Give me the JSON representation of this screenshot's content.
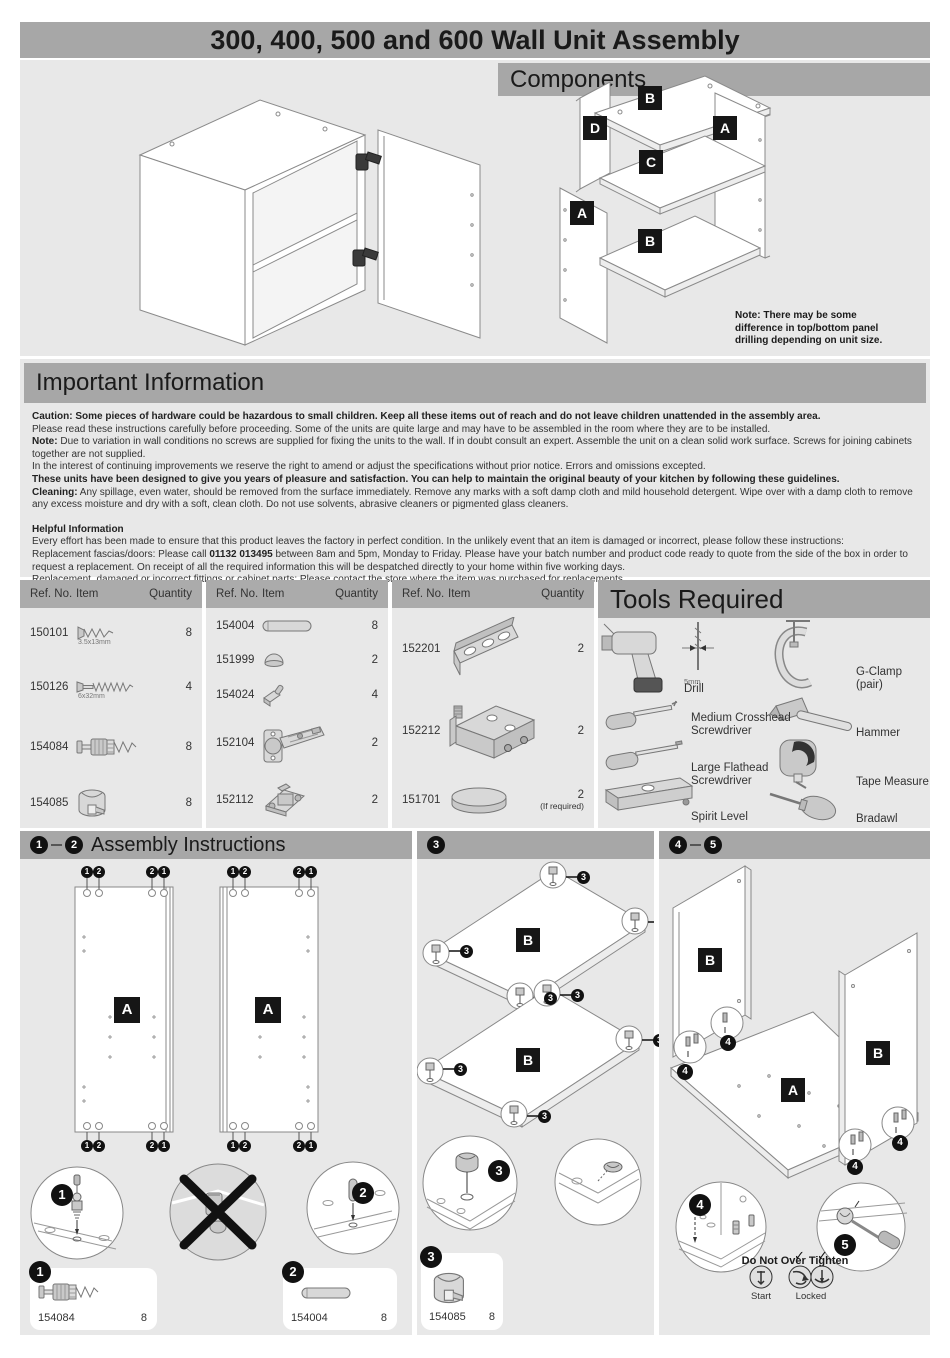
{
  "title": "300, 400, 500 and 600 Wall Unit Assembly",
  "components": {
    "header": "Components",
    "note": "Note: There may be some difference in top/bottom panel drilling depending on unit size.",
    "label_a": "A",
    "label_b": "B",
    "label_c": "C",
    "label_d": "D"
  },
  "important": {
    "header": "Important Information",
    "p1": "Caution: Some pieces of hardware could be hazardous to small children. Keep all these items out of reach and do not leave children unattended in the assembly area.",
    "p2": "Please read these instructions carefully before proceeding. Some of the units are quite large and may have to be assembled in the room where they are to be installed.",
    "p3_bold": "Note:",
    "p3_rest": " Due to variation in wall conditions no screws are supplied for fixing the units to the wall. If in doubt consult an expert. Assemble the unit on a clean solid work surface. Screws for joining cabinets together are not supplied.",
    "p4": "In the interest of continuing improvements we reserve the right to amend or adjust the specifications without prior notice. Errors and omissions excepted.",
    "p5": "These units have been designed to give you years of pleasure and satisfaction. You can help to maintain the original beauty of your kitchen by following these guidelines.",
    "p6_bold": "Cleaning:",
    "p6_rest": " Any spillage, even water, should be removed from the surface immediately. Remove any marks with a soft damp cloth and mild household detergent. Wipe over with a damp cloth to remove any excess moisture and dry with a soft, clean cloth. Do not use solvents, abrasive cleaners or pigmented glass cleaners.",
    "helpful_header": "Helpful Information",
    "h1": "Every effort has been made to ensure that this product leaves the factory in perfect condition. In the unlikely event that an item is damaged or incorrect, please follow these instructions:",
    "h2_pre": "Replacement fascias/doors: Please call ",
    "h2_bold": "01132 013495",
    "h2_rest": " between 8am and 5pm, Monday to Friday. Please have your batch number and product code ready to quote from the side of the box in order to request a replacement. On receipt of all the required information this will be despatched directly to your home within five working days.",
    "h3": "Replacement, damaged or incorrect fittings or cabinet parts: Please contact the store where the item was purchased for replacements."
  },
  "parts_header": {
    "ref": "Ref. No.",
    "item": "Item",
    "qty": "Quantity"
  },
  "parts": {
    "t1": [
      {
        "ref": "150101",
        "qty": "8",
        "size": "3.5x13mm"
      },
      {
        "ref": "150126",
        "qty": "4",
        "size": "6x32mm"
      },
      {
        "ref": "154084",
        "qty": "8"
      },
      {
        "ref": "154085",
        "qty": "8"
      }
    ],
    "t2": [
      {
        "ref": "154004",
        "qty": "8"
      },
      {
        "ref": "151999",
        "qty": "2"
      },
      {
        "ref": "154024",
        "qty": "4"
      },
      {
        "ref": "152104",
        "qty": "2"
      },
      {
        "ref": "152112",
        "qty": "2"
      }
    ],
    "t3": [
      {
        "ref": "152201",
        "qty": "2"
      },
      {
        "ref": "152212",
        "qty": "2"
      },
      {
        "ref": "151701",
        "qty": "2",
        "qty_note": "(If required)"
      }
    ]
  },
  "tools": {
    "header": "Tools Required",
    "drill_size": "5mm",
    "drill": "Drill",
    "crosshead": "Medium Crosshead Screwdriver",
    "flathead": "Large Flathead Screwdriver",
    "spirit": "Spirit Level",
    "gclamp": "G-Clamp (pair)",
    "hammer": "Hammer",
    "tape": "Tape Measure",
    "bradawl": "Bradawl"
  },
  "assembly": {
    "header1": "Assembly Instructions",
    "s1": "1",
    "s2": "2",
    "s3": "3",
    "s4": "4",
    "s5": "5",
    "label_a": "A",
    "label_b": "B",
    "card1": {
      "ref": "154084",
      "qty": "8"
    },
    "card2": {
      "ref": "154004",
      "qty": "8"
    },
    "card3": {
      "ref": "154085",
      "qty": "8"
    },
    "warn": "Do Not Over Tighten",
    "start_label": "Start",
    "locked_label": "Locked",
    "check_icon": "✓"
  }
}
